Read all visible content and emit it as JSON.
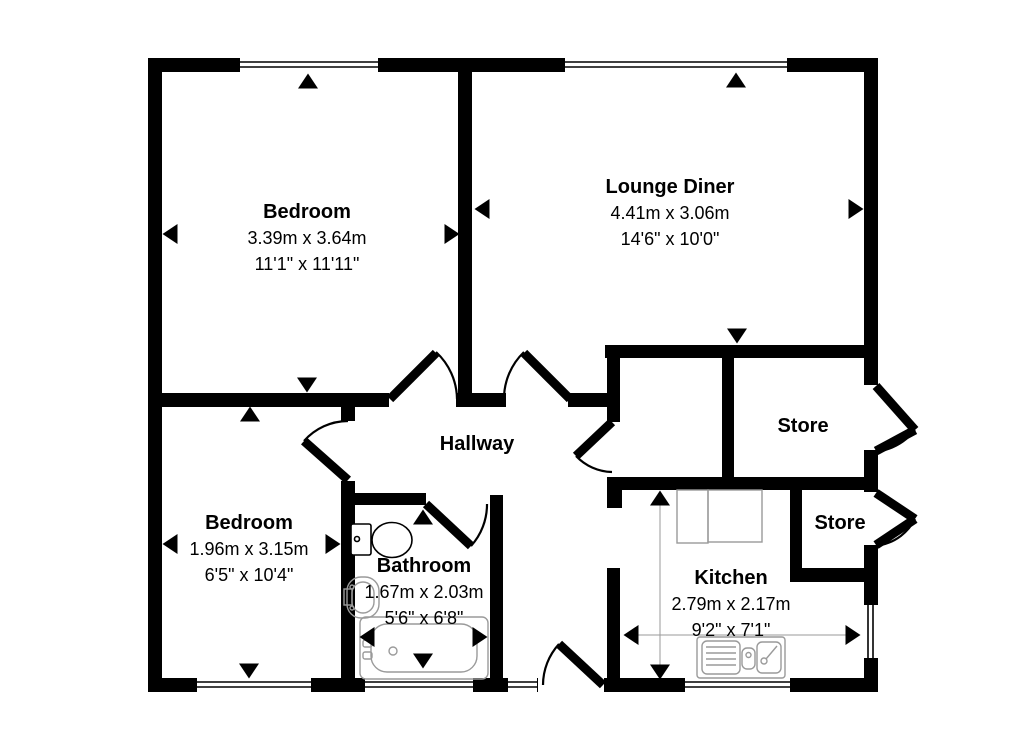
{
  "plan": {
    "rooms": [
      {
        "id": "bedroom-1",
        "name": "Bedroom",
        "metric": "3.39m x 3.64m",
        "imperial": "11'1\" x 11'11\""
      },
      {
        "id": "lounge-diner",
        "name": "Lounge Diner",
        "metric": "4.41m x 3.06m",
        "imperial": "14'6\" x 10'0\""
      },
      {
        "id": "bedroom-2",
        "name": "Bedroom",
        "metric": "1.96m x 3.15m",
        "imperial": "6'5\" x 10'4\""
      },
      {
        "id": "bathroom",
        "name": "Bathroom",
        "metric": "1.67m x 2.03m",
        "imperial": "5'6\" x 6'8\""
      },
      {
        "id": "kitchen",
        "name": "Kitchen",
        "metric": "2.79m x 2.17m",
        "imperial": "9'2\" x 7'1\""
      },
      {
        "id": "hallway",
        "name": "Hallway"
      },
      {
        "id": "store-1",
        "name": "Store"
      },
      {
        "id": "store-2",
        "name": "Store"
      }
    ],
    "fixtures": [
      "toilet",
      "wash-basin",
      "bathtub",
      "kitchen-sink",
      "kitchen-counter"
    ],
    "colors": {
      "wall": "#000000",
      "background": "#ffffff",
      "fixture_line": "#9a9a9a",
      "text": "#000000"
    }
  }
}
